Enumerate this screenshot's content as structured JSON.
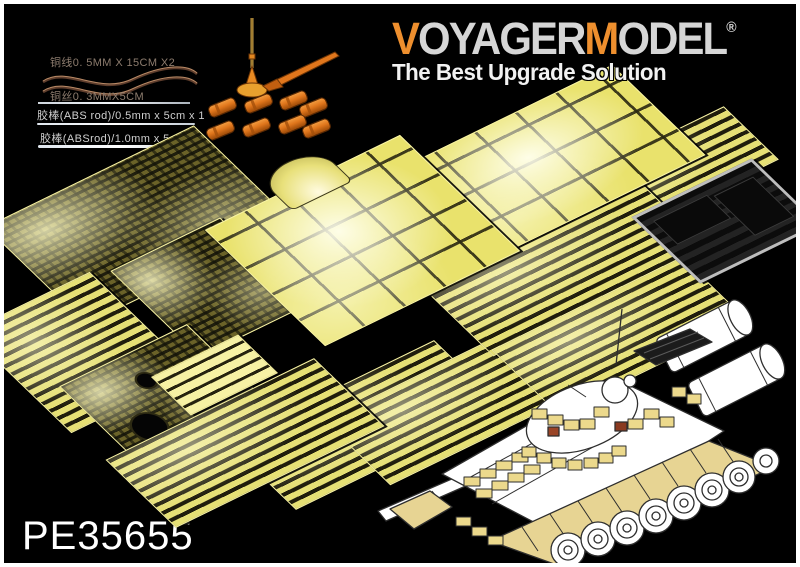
{
  "product": {
    "code": "PE35655"
  },
  "brand": {
    "logo_segments": [
      {
        "text": "V"
      },
      {
        "text": "OYAGER"
      },
      {
        "text": "M"
      },
      {
        "text": "ODEL"
      }
    ],
    "registered_mark": "®",
    "tagline": "The Best Upgrade Solution"
  },
  "materials": {
    "items": [
      {
        "label": "铜线0. 5MM X 15CM X2"
      },
      {
        "label": "铜丝0. 3MMX5CM"
      },
      {
        "label": "胶棒(ABS rod)/0.5mm x 5cm x 1"
      },
      {
        "label": "胶棒(ABSrod)/1.0mm x 5cm x 1"
      }
    ]
  },
  "colors": {
    "background": "#000000",
    "frame_border": "#ffffff",
    "pe_sheet_yellow": "#e9e26c",
    "logo_orange": "#ee8f2e",
    "logo_gray": "#d6d6d6",
    "tagline_white": "#f2f2f2",
    "tool_orange": "#e0761c",
    "tank_skirt_tan": "#e7d493",
    "film_sheet_gray": "#141414"
  }
}
